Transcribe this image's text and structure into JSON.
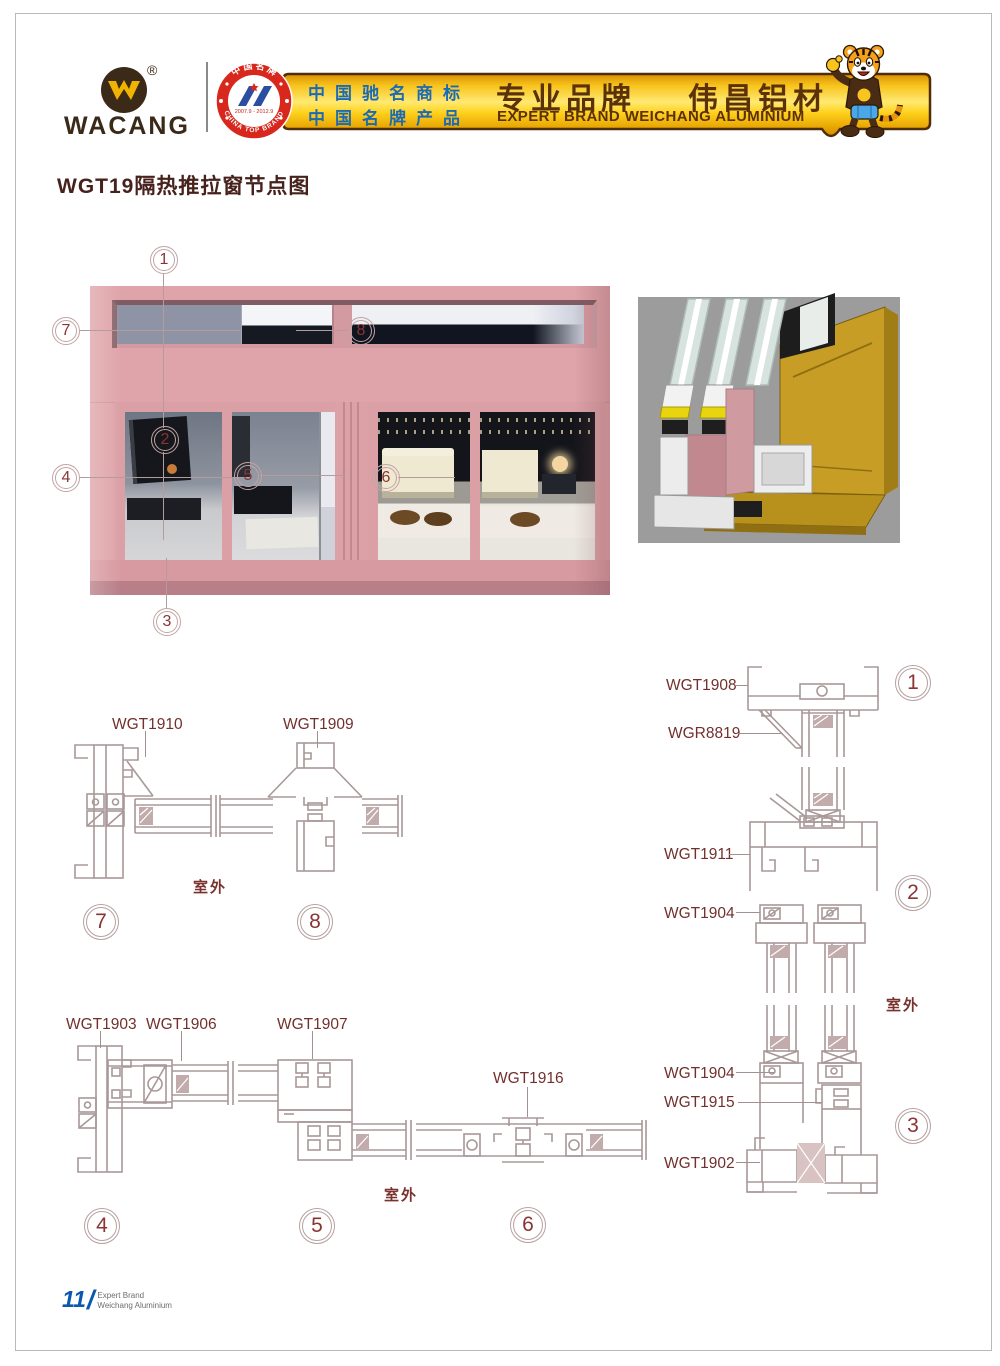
{
  "icons": {
    "logo": "wacang-w-logo",
    "badge": "china-top-brand-badge",
    "mascot": "tiger-mascot",
    "render": "window-profile-3d-render"
  },
  "header": {
    "brand": "WACANG",
    "registered": "®",
    "badge": {
      "arc_top": "中国名牌",
      "arc_bottom": "CHINA TOP BRAND",
      "years": "2007.9 - 2012.9"
    },
    "banner": {
      "line1": "中国驰名商标",
      "line2": "中国名牌产品",
      "headline_left": "专业品牌",
      "headline_right": "伟昌铝材",
      "subtitle": "EXPERT BRAND WEICHANG ALUMINIUM"
    }
  },
  "page_title": "WGT19隔热推拉窗节点图",
  "elevation": {
    "callouts": [
      "1",
      "7",
      "8",
      "2",
      "4",
      "5",
      "6",
      "3"
    ]
  },
  "details": {
    "outdoor": "室外",
    "numbers": [
      "1",
      "2",
      "3",
      "4",
      "5",
      "6",
      "7",
      "8"
    ],
    "labels": {
      "wgt1910": "WGT1910",
      "wgt1909": "WGT1909",
      "wgt1908": "WGT1908",
      "wgr8819": "WGR8819",
      "wgt1911": "WGT1911",
      "wgt1904a": "WGT1904",
      "wgt1904b": "WGT1904",
      "wgt1915": "WGT1915",
      "wgt1902": "WGT1902",
      "wgt1903": "WGT1903",
      "wgt1906": "WGT1906",
      "wgt1907": "WGT1907",
      "wgt1916": "WGT1916"
    }
  },
  "footer": {
    "page_number": "11",
    "line1": "Expert Brand",
    "line2": "Weichang Aluminium"
  },
  "colors": {
    "banner_gold": "#f7c31c",
    "text_brown": "#5b3109",
    "text_blue": "#1b6ab5",
    "frame_pink": "#dfa4a9",
    "line": "#a89898",
    "label": "#72302c",
    "footer_blue": "#0a58b0"
  }
}
